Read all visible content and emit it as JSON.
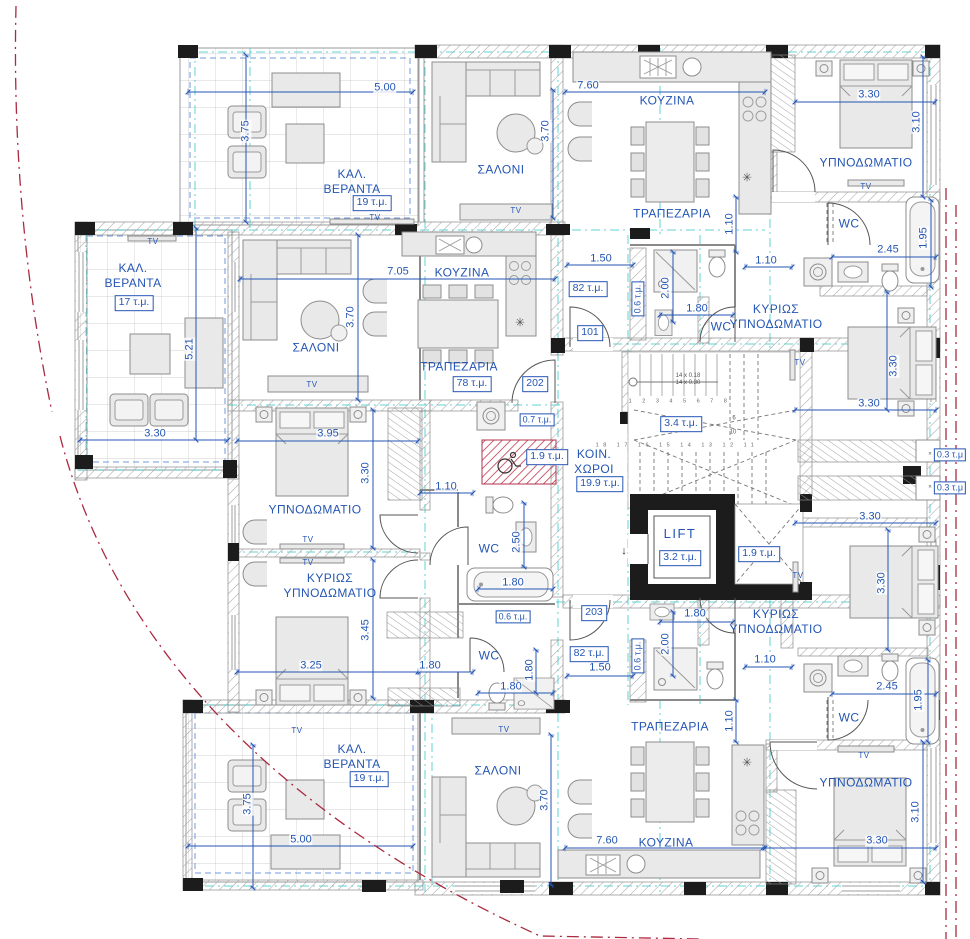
{
  "plan": {
    "colors": {
      "annotation_blue": "#2456b4",
      "axis_teal": "#2cc4c4",
      "boundary_red": "#aa2a40",
      "hatch_red": "#c23347",
      "wall_gray": "#8a8a8a",
      "column_black": "#1c1c1c",
      "furniture_gray": "#e9e9e9"
    },
    "apartments": [
      {
        "number": "101",
        "area": "82 τ.μ."
      },
      {
        "number": "202",
        "area": "78 τ.μ."
      },
      {
        "number": "203",
        "area": "82 τ.μ."
      }
    ],
    "labels": [
      {
        "n": "label-kal-veranta-top",
        "t": "ΚΑΛ.\nΒΕΡΑΝΤΑ",
        "x": 352,
        "y": 182,
        "c": "room"
      },
      {
        "n": "area-veranta-top",
        "t": "19 τ.μ.",
        "x": 372,
        "y": 203,
        "c": "box"
      },
      {
        "n": "label-saloni-top",
        "t": "ΣΑΛΟΝΙ",
        "x": 501,
        "y": 170,
        "c": "room"
      },
      {
        "n": "label-kouzina-101",
        "t": "ΚΟΥΖΙΝΑ",
        "x": 667,
        "y": 101,
        "c": "room"
      },
      {
        "n": "label-trapezaria-101",
        "t": "ΤΡΑΠΕΖΑΡΙΑ",
        "x": 672,
        "y": 214,
        "c": "room"
      },
      {
        "n": "label-ypnodomatio-101",
        "t": "ΥΠΝΟΔΩΜΑΤΙΟ",
        "x": 866,
        "y": 163,
        "c": "room"
      },
      {
        "n": "label-wc-101-top",
        "t": "WC",
        "x": 849,
        "y": 224,
        "c": "room"
      },
      {
        "n": "label-kyrios-101",
        "t": "ΚΥΡΙΩΣ\nΥΠΝΟΔΩΜΑΤΙΟ",
        "x": 776,
        "y": 317,
        "c": "room"
      },
      {
        "n": "label-wc-101-small",
        "t": "WC",
        "x": 721,
        "y": 327,
        "c": "room"
      },
      {
        "n": "apt-101",
        "t": "101",
        "x": 590,
        "y": 333,
        "c": "box"
      },
      {
        "n": "area-apt-101",
        "t": "82 τ.μ.",
        "x": 588,
        "y": 289,
        "c": "box"
      },
      {
        "n": "label-kal-veranta-left",
        "t": "ΚΑΛ.\nΒΕΡΑΝΤΑ",
        "x": 133,
        "y": 276,
        "c": "room"
      },
      {
        "n": "area-veranta-left",
        "t": "17 τ.μ.",
        "x": 134,
        "y": 303,
        "c": "box"
      },
      {
        "n": "label-saloni-202",
        "t": "ΣΑΛΟΝΙ",
        "x": 316,
        "y": 348,
        "c": "room"
      },
      {
        "n": "label-kouzina-202",
        "t": "ΚΟΥΖΙΝΑ",
        "x": 462,
        "y": 273,
        "c": "room"
      },
      {
        "n": "label-trapezaria-202",
        "t": "ΤΡΑΠΕΖΑΡΙΑ",
        "x": 459,
        "y": 367,
        "c": "room"
      },
      {
        "n": "area-apt-202",
        "t": "78 τ.μ.",
        "x": 472,
        "y": 384,
        "c": "box"
      },
      {
        "n": "apt-202",
        "t": "202",
        "x": 535,
        "y": 384,
        "c": "box"
      },
      {
        "n": "label-ypnodomatio-202",
        "t": "ΥΠΝΟΔΩΜΑΤΙΟ",
        "x": 315,
        "y": 510,
        "c": "room"
      },
      {
        "n": "label-kyrios-202",
        "t": "ΚΥΡΙΩΣ\nΥΠΝΟΔΩΜΑΤΙΟ",
        "x": 330,
        "y": 586,
        "c": "room"
      },
      {
        "n": "label-koin-choroi",
        "t": "ΚΟΙΝ.\nΧΩΡΟΙ",
        "x": 594,
        "y": 462,
        "c": "room"
      },
      {
        "n": "area-koin-choroi",
        "t": "19.9 τ.μ.",
        "x": 600,
        "y": 484,
        "c": "box"
      },
      {
        "n": "area-stairs",
        "t": "3.4 τ.μ.",
        "x": 681,
        "y": 424,
        "c": "box"
      },
      {
        "n": "label-lift",
        "t": "LIFT",
        "x": 680,
        "y": 534,
        "c": "lift"
      },
      {
        "n": "area-lift",
        "t": "3.2 τ.μ.",
        "x": 680,
        "y": 558,
        "c": "box"
      },
      {
        "n": "area-shaft",
        "t": "1.9 τ.μ.",
        "x": 759,
        "y": 554,
        "c": "box"
      },
      {
        "n": "area-storage-07",
        "t": "0.7 τ.μ.",
        "x": 537,
        "y": 420,
        "c": "boxs"
      },
      {
        "n": "area-wc-disabled",
        "t": "1.9 τ.μ.",
        "x": 547,
        "y": 457,
        "c": "box"
      },
      {
        "n": "label-wc-202-mid",
        "t": "WC",
        "x": 489,
        "y": 549,
        "c": "room"
      },
      {
        "n": "area-niche-202",
        "t": "0.6 τ.μ.",
        "x": 513,
        "y": 617,
        "c": "boxs"
      },
      {
        "n": "label-wc-202-low",
        "t": "WC",
        "x": 489,
        "y": 656,
        "c": "room"
      },
      {
        "n": "apt-203",
        "t": "203",
        "x": 594,
        "y": 613,
        "c": "box"
      },
      {
        "n": "area-apt-203",
        "t": "82 τ.μ.",
        "x": 589,
        "y": 654,
        "c": "box"
      },
      {
        "n": "label-trapezaria-203",
        "t": "ΤΡΑΠΕΖΑΡΙΑ",
        "x": 670,
        "y": 727,
        "c": "room"
      },
      {
        "n": "label-kouzina-203",
        "t": "ΚΟΥΖΙΝΑ",
        "x": 666,
        "y": 843,
        "c": "room"
      },
      {
        "n": "label-ypnodomatio-203",
        "t": "ΥΠΝΟΔΩΜΑΤΙΟ",
        "x": 866,
        "y": 783,
        "c": "room"
      },
      {
        "n": "label-kyrios-203",
        "t": "ΚΥΡΙΩΣ\nΥΠΝΟΔΩΜΑΤΙΟ",
        "x": 776,
        "y": 622,
        "c": "room"
      },
      {
        "n": "label-wc-203",
        "t": "WC",
        "x": 849,
        "y": 718,
        "c": "room"
      },
      {
        "n": "label-kal-veranta-bottom",
        "t": "ΚΑΛ.\nΒΕΡΑΝΤΑ",
        "x": 352,
        "y": 757,
        "c": "room"
      },
      {
        "n": "area-veranta-bottom",
        "t": "19 τ.μ.",
        "x": 369,
        "y": 779,
        "c": "box"
      },
      {
        "n": "label-saloni-bottom",
        "t": "ΣΑΛΟΝΙ",
        "x": 498,
        "y": 771,
        "c": "room"
      },
      {
        "n": "area-niche-101",
        "t": "0.6 τ.μ.",
        "x": 638,
        "y": 299,
        "c": "boxs",
        "r": -90
      },
      {
        "n": "area-niche-203",
        "t": "0.6 τ.μ.",
        "x": 638,
        "y": 656,
        "c": "boxs",
        "r": -90
      },
      {
        "n": "area-ward-a",
        "t": "0.3 τ.μ",
        "x": 950,
        "y": 455,
        "c": "boxs"
      },
      {
        "n": "area-ward-b",
        "t": "0.3 τ.μ",
        "x": 950,
        "y": 488,
        "c": "boxs"
      },
      {
        "n": "x-mark-a",
        "t": "×",
        "x": 930,
        "y": 455,
        "c": "tiny"
      },
      {
        "n": "x-mark-b",
        "t": "×",
        "x": 930,
        "y": 488,
        "c": "tiny"
      },
      {
        "n": "stair-riser-note",
        "t": "14 x 0.18\n14 x 0.30",
        "x": 688,
        "y": 380,
        "c": "tiny"
      },
      {
        "n": "stair-numbers-upper",
        "t": "1 2 3 4 5 6 7 8",
        "x": 680,
        "y": 402,
        "c": "num"
      },
      {
        "n": "stair-numbers-lower",
        "t": "18 17 16 15 14 13 12 11",
        "x": 677,
        "y": 446,
        "c": "num"
      },
      {
        "n": "stair-number-6",
        "t": "6",
        "x": 734,
        "y": 419,
        "c": "tiny"
      },
      {
        "n": "stair-number-10",
        "t": "10",
        "x": 733,
        "y": 433,
        "c": "tiny"
      },
      {
        "n": "lift-direction-arrow",
        "t": "↓",
        "x": 624,
        "y": 552,
        "c": "arrow"
      },
      {
        "n": "dim-veranda-top-w",
        "t": "5.00",
        "x": 385,
        "y": 88,
        "c": "dim"
      },
      {
        "n": "dim-veranda-top-h",
        "t": "3.75",
        "x": 246,
        "y": 131,
        "c": "dim",
        "r": -90
      },
      {
        "n": "dim-saloni-top-h",
        "t": "3.70",
        "x": 546,
        "y": 131,
        "c": "dim",
        "r": -90
      },
      {
        "n": "dim-kouzina-101-w",
        "t": "7.60",
        "x": 588,
        "y": 86,
        "c": "dim"
      },
      {
        "n": "dim-ypn-101-w",
        "t": "3.30",
        "x": 869,
        "y": 95,
        "c": "dim"
      },
      {
        "n": "dim-ypn-101-h",
        "t": "3.10",
        "x": 917,
        "y": 122,
        "c": "dim",
        "r": -90
      },
      {
        "n": "dim-101-hall-v",
        "t": "1.10",
        "x": 730,
        "y": 224,
        "c": "dim",
        "r": -90
      },
      {
        "n": "dim-101-entry",
        "t": "1.50",
        "x": 601,
        "y": 259,
        "c": "dim"
      },
      {
        "n": "dim-bath-101-h",
        "t": "2.00",
        "x": 666,
        "y": 288,
        "c": "dim",
        "r": -90
      },
      {
        "n": "dim-bath-101-w",
        "t": "1.80",
        "x": 697,
        "y": 309,
        "c": "dim"
      },
      {
        "n": "dim-101-hall-h",
        "t": "1.10",
        "x": 766,
        "y": 261,
        "c": "dim"
      },
      {
        "n": "dim-wc-101-w",
        "t": "2.45",
        "x": 888,
        "y": 250,
        "c": "dim"
      },
      {
        "n": "dim-wc-101-h",
        "t": "1.95",
        "x": 924,
        "y": 238,
        "c": "dim",
        "r": -90
      },
      {
        "n": "dim-saloni-202-w",
        "t": "7.05",
        "x": 398,
        "y": 272,
        "c": "dim"
      },
      {
        "n": "dim-saloni-202-h",
        "t": "3.70",
        "x": 351,
        "y": 317,
        "c": "dim",
        "r": -90
      },
      {
        "n": "dim-veranda-left-h",
        "t": "5.21",
        "x": 190,
        "y": 349,
        "c": "dim",
        "r": -90
      },
      {
        "n": "dim-veranda-left-w",
        "t": "3.30",
        "x": 155,
        "y": 434,
        "c": "dim"
      },
      {
        "n": "dim-ypn-202-w",
        "t": "3.95",
        "x": 328,
        "y": 434,
        "c": "dim"
      },
      {
        "n": "dim-ypn-202-h",
        "t": "3.30",
        "x": 366,
        "y": 473,
        "c": "dim",
        "r": -90
      },
      {
        "n": "dim-hall-202",
        "t": "1.10",
        "x": 446,
        "y": 487,
        "c": "dim"
      },
      {
        "n": "dim-kyr-101-h",
        "t": "3.30",
        "x": 894,
        "y": 366,
        "c": "dim",
        "r": -90
      },
      {
        "n": "dim-kyr-101-w",
        "t": "3.30",
        "x": 869,
        "y": 404,
        "c": "dim"
      },
      {
        "n": "dim-wc-202-h",
        "t": "2.50",
        "x": 517,
        "y": 542,
        "c": "dim",
        "r": -90
      },
      {
        "n": "dim-tub-202",
        "t": "1.80",
        "x": 513,
        "y": 583,
        "c": "dim"
      },
      {
        "n": "dim-kyr-202-h",
        "t": "3.45",
        "x": 366,
        "y": 630,
        "c": "dim",
        "r": -90
      },
      {
        "n": "dim-kyr-202-w",
        "t": "3.25",
        "x": 311,
        "y": 666,
        "c": "dim"
      },
      {
        "n": "dim-202-low-a",
        "t": "1.80",
        "x": 430,
        "y": 666,
        "c": "dim"
      },
      {
        "n": "dim-202-low-b",
        "t": "1.80",
        "x": 511,
        "y": 687,
        "c": "dim"
      },
      {
        "n": "dim-202-low-c",
        "t": "1.80",
        "x": 530,
        "y": 670,
        "c": "dim",
        "r": -90
      },
      {
        "n": "dim-kyr-203-w",
        "t": "3.30",
        "x": 870,
        "y": 517,
        "c": "dim"
      },
      {
        "n": "dim-kyr-203-h",
        "t": "3.30",
        "x": 882,
        "y": 583,
        "c": "dim",
        "r": -90
      },
      {
        "n": "dim-bath-203-w",
        "t": "1.80",
        "x": 695,
        "y": 614,
        "c": "dim"
      },
      {
        "n": "dim-203-entry",
        "t": "1.50",
        "x": 600,
        "y": 668,
        "c": "dim"
      },
      {
        "n": "dim-bath-203-h",
        "t": "2.00",
        "x": 666,
        "y": 644,
        "c": "dim",
        "r": -90
      },
      {
        "n": "dim-203-hall-h",
        "t": "1.10",
        "x": 765,
        "y": 660,
        "c": "dim"
      },
      {
        "n": "dim-wc-203-w",
        "t": "2.45",
        "x": 887,
        "y": 687,
        "c": "dim"
      },
      {
        "n": "dim-wc-203-h",
        "t": "1.95",
        "x": 919,
        "y": 700,
        "c": "dim",
        "r": -90
      },
      {
        "n": "dim-203-hall-v",
        "t": "1.10",
        "x": 730,
        "y": 721,
        "c": "dim",
        "r": -90
      },
      {
        "n": "dim-ypn-203-h",
        "t": "3.10",
        "x": 916,
        "y": 812,
        "c": "dim",
        "r": -90
      },
      {
        "n": "dim-ypn-203-w",
        "t": "3.30",
        "x": 877,
        "y": 841,
        "c": "dim"
      },
      {
        "n": "dim-kouzina-203-w",
        "t": "7.60",
        "x": 607,
        "y": 841,
        "c": "dim"
      },
      {
        "n": "dim-veranda-bot-w",
        "t": "5.00",
        "x": 301,
        "y": 840,
        "c": "dim"
      },
      {
        "n": "dim-veranda-bot-h",
        "t": "3.75",
        "x": 248,
        "y": 804,
        "c": "dim",
        "r": -90
      },
      {
        "n": "dim-saloni-bot-h",
        "t": "3.70",
        "x": 545,
        "y": 800,
        "c": "dim",
        "r": -90
      },
      {
        "n": "tv-veranda-top",
        "t": "TV",
        "x": 375,
        "y": 218,
        "c": "tv"
      },
      {
        "n": "tv-saloni-top",
        "t": "TV",
        "x": 516,
        "y": 211,
        "c": "tv"
      },
      {
        "n": "tv-veranda-left",
        "t": "TV",
        "x": 153,
        "y": 242,
        "c": "tv"
      },
      {
        "n": "tv-saloni-202",
        "t": "TV",
        "x": 312,
        "y": 385,
        "c": "tv"
      },
      {
        "n": "tv-ypn-202",
        "t": "TV",
        "x": 308,
        "y": 540,
        "c": "tv"
      },
      {
        "n": "tv-kyrios-202",
        "t": "TV",
        "x": 308,
        "y": 563,
        "c": "tv"
      },
      {
        "n": "tv-saloni-bottom",
        "t": "TV",
        "x": 504,
        "y": 730,
        "c": "tv"
      },
      {
        "n": "tv-veranda-bottom",
        "t": "TV",
        "x": 297,
        "y": 731,
        "c": "tv"
      },
      {
        "n": "tv-ypn-101",
        "t": "TV",
        "x": 866,
        "y": 187,
        "c": "tv"
      },
      {
        "n": "tv-kyrios-101",
        "t": "TV",
        "x": 800,
        "y": 363,
        "c": "tv"
      },
      {
        "n": "tv-kyrios-203",
        "t": "TV",
        "x": 798,
        "y": 576,
        "c": "tv"
      },
      {
        "n": "tv-ypn-203",
        "t": "TV",
        "x": 864,
        "y": 756,
        "c": "tv"
      },
      {
        "n": "sym-boiler-101",
        "t": "✳",
        "x": 747,
        "y": 178,
        "c": "sym"
      },
      {
        "n": "sym-boiler-202",
        "t": "✳",
        "x": 520,
        "y": 323,
        "c": "sym"
      },
      {
        "n": "sym-boiler-203",
        "t": "✳",
        "x": 747,
        "y": 763,
        "c": "sym"
      }
    ]
  }
}
